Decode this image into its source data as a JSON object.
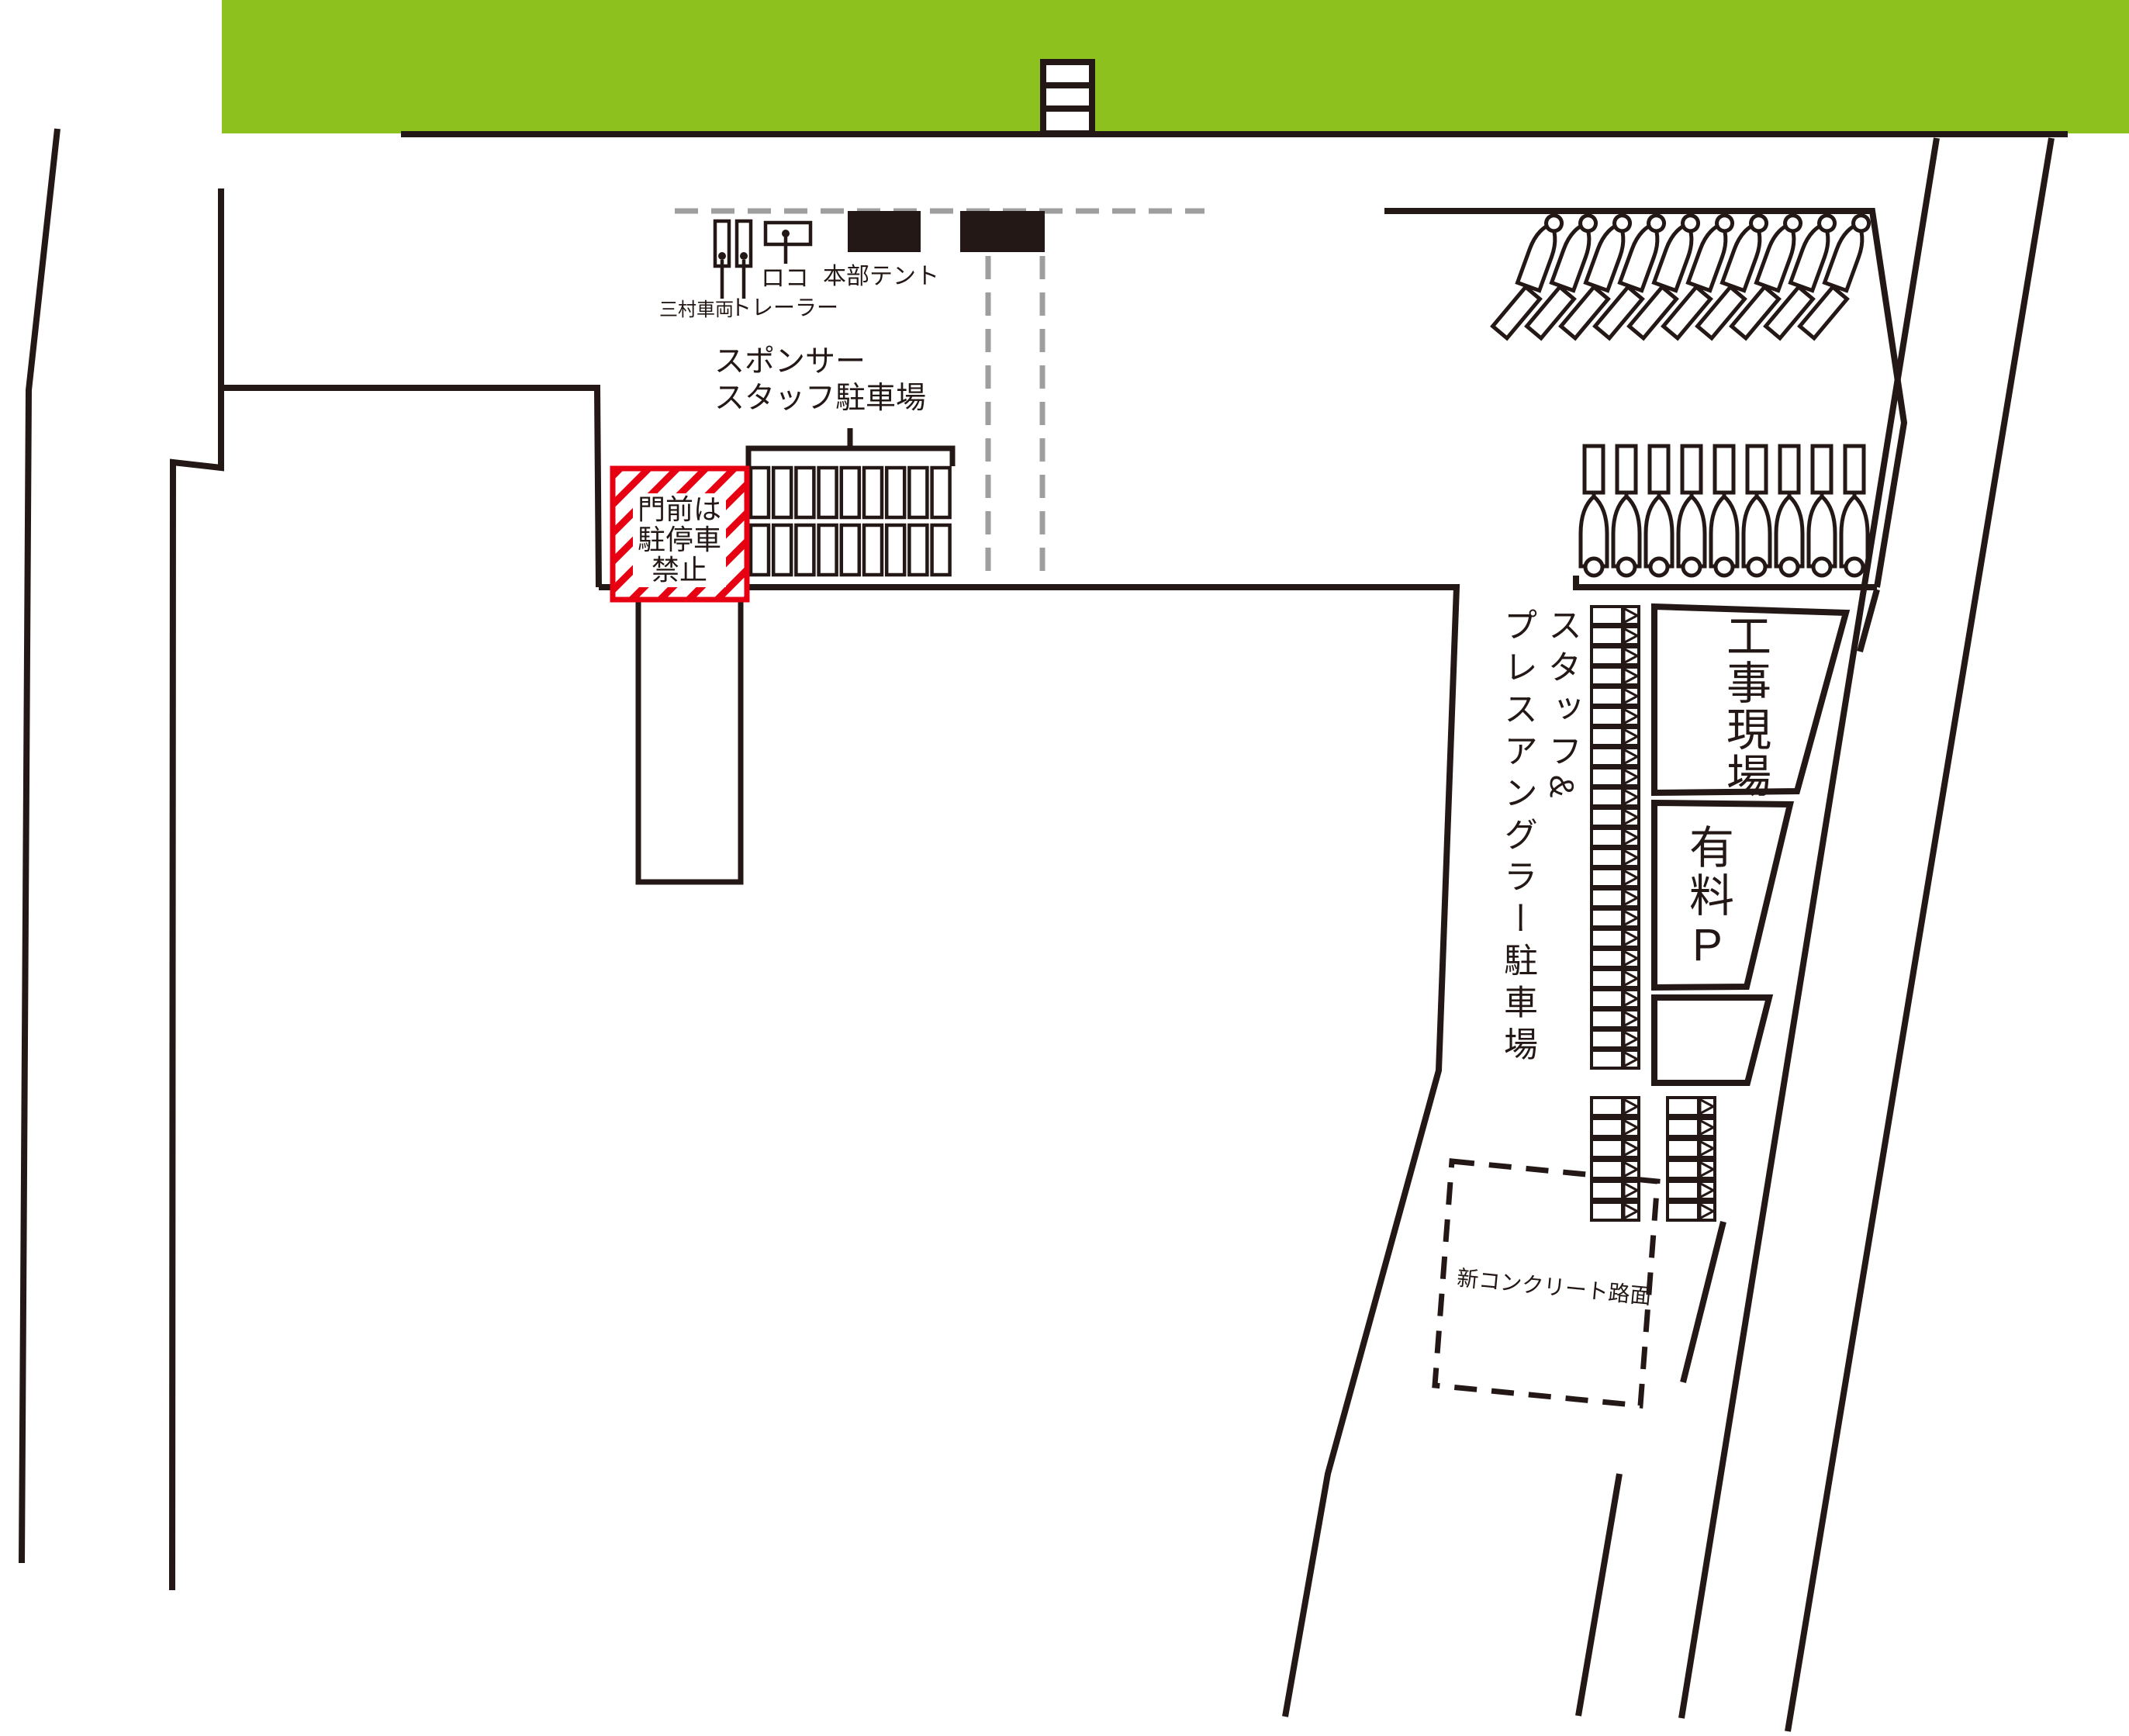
{
  "colors": {
    "green": "#8dc21e",
    "red": "#e60012",
    "line": "#231815",
    "dash_gray": "#9e9e9f",
    "white": "#ffffff"
  },
  "hq_area": {
    "mimura_label": "三村車両",
    "trailer_label": "トレーラー",
    "loco_label": "ロコ",
    "tent_label": "本部テント"
  },
  "sponsor_parking": {
    "label_line1": "スポンサー",
    "label_line2": "スタッフ駐車場",
    "rows": 2,
    "stalls_per_row": 9
  },
  "gate_warning": {
    "line1": "門前は",
    "line2": "駐停車",
    "line3": "禁止"
  },
  "trailer_area": {
    "row1_boats": 10,
    "row2_boats": 9
  },
  "staff_press_parking": {
    "label_col1": "スタッフ&",
    "label_col2": "プレスアングラー駐車場",
    "column_stalls": 23,
    "bottom_left_stalls": 6,
    "bottom_right_stalls": 6
  },
  "construction_site": {
    "label": "工事現場"
  },
  "paid_parking": {
    "label": "有料P"
  },
  "new_concrete": {
    "label": "新コンクリート路面"
  }
}
